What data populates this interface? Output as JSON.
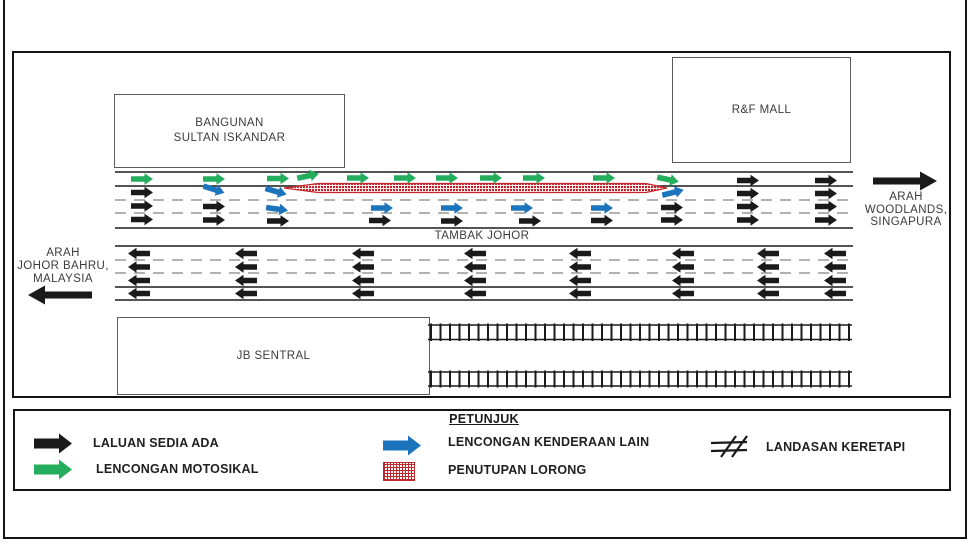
{
  "colors": {
    "existing_route": "#1A1A1A",
    "motorcycle_diversion": "#25AD5E",
    "other_vehicle_diversion": "#1C75BC",
    "lane_closure": "#C1272D",
    "label_text": "#3B3B3B"
  },
  "buildings": [
    {
      "name": "bangunan-sultan-iskandar",
      "lines": [
        "BANGUNAN",
        "SULTAN ISKANDAR"
      ]
    },
    {
      "name": "rf-mall",
      "lines": [
        "R&F MALL"
      ]
    },
    {
      "name": "jb-sentral",
      "lines": [
        "JB SENTRAL"
      ]
    }
  ],
  "labels": {
    "causeway": "TAMBAK JOHOR",
    "left_direction": [
      "ARAH",
      "JOHOR BAHRU,",
      "MALAYSIA"
    ],
    "right_direction": [
      "ARAH",
      "WOODLANDS,",
      "SINGAPURA"
    ]
  },
  "legend": {
    "title": "PETUNJUK",
    "items": [
      {
        "icon": "black-arrow-icon",
        "label": "LALUAN SEDIA ADA"
      },
      {
        "icon": "green-arrow-icon",
        "label": "LENCONGAN MOTOSIKAL"
      },
      {
        "icon": "blue-arrow-icon",
        "label": "LENCONGAN KENDERAAN LAIN"
      },
      {
        "icon": "red-hatch-icon",
        "label": "PENUTUPAN LORONG"
      },
      {
        "icon": "railway-icon",
        "label": "LANDASAN KERETAPI"
      }
    ]
  },
  "diagram": {
    "top_road": {
      "x1": 115,
      "x2": 853,
      "solid_lines": [
        172,
        186,
        228
      ],
      "dashed_lines": [
        200,
        213
      ]
    },
    "bottom_road": {
      "x1": 115,
      "x2": 853,
      "solid_lines": [
        246,
        287,
        300
      ],
      "dashed_lines": [
        260,
        273
      ]
    },
    "railways": [
      {
        "x1": 428,
        "x2": 852,
        "y1": 325,
        "y2": 339.5
      },
      {
        "x1": 428,
        "x2": 852,
        "y1": 372,
        "y2": 386
      }
    ],
    "closure_polygon": "284,188 318,183.5 646,183.5 667,188 646,192.5 318,192.5",
    "arrows_small": [
      [
        142,
        179,
        0,
        "g"
      ],
      [
        214,
        179,
        0,
        "g"
      ],
      [
        278,
        178.5,
        0,
        "g"
      ],
      [
        308,
        176,
        -12,
        "g"
      ],
      [
        358,
        178,
        0,
        "g"
      ],
      [
        405,
        178,
        0,
        "g"
      ],
      [
        447,
        178,
        0,
        "g"
      ],
      [
        491,
        178,
        0,
        "g"
      ],
      [
        534,
        178,
        0,
        "g"
      ],
      [
        604,
        178,
        0,
        "g"
      ],
      [
        668,
        179.5,
        12,
        "g"
      ],
      [
        214,
        189.5,
        18,
        "b"
      ],
      [
        276,
        191.5,
        16,
        "b"
      ],
      [
        277,
        209,
        8,
        "b"
      ],
      [
        382,
        208,
        0,
        "b"
      ],
      [
        452,
        208,
        0,
        "b"
      ],
      [
        522,
        208,
        0,
        "b"
      ],
      [
        602,
        208,
        0,
        "b"
      ],
      [
        673,
        192.5,
        -14,
        "b"
      ],
      [
        142,
        192.5,
        0,
        "k"
      ],
      [
        142,
        206,
        0,
        "k"
      ],
      [
        142,
        219.5,
        0,
        "k"
      ],
      [
        214,
        206.5,
        0,
        "k"
      ],
      [
        214,
        220,
        0,
        "k"
      ],
      [
        278,
        221,
        0,
        "k"
      ],
      [
        380,
        220.5,
        0,
        "k"
      ],
      [
        452,
        221,
        0,
        "k"
      ],
      [
        530,
        221,
        0,
        "k"
      ],
      [
        602,
        220.5,
        0,
        "k"
      ],
      [
        672,
        207.5,
        0,
        "k"
      ],
      [
        672,
        220,
        0,
        "k"
      ],
      [
        748,
        180.5,
        0,
        "k"
      ],
      [
        748,
        193.5,
        0,
        "k"
      ],
      [
        748,
        206.5,
        0,
        "k"
      ],
      [
        748,
        220,
        0,
        "k"
      ],
      [
        826,
        180.5,
        0,
        "k"
      ],
      [
        826,
        193.5,
        0,
        "k"
      ],
      [
        826,
        206.5,
        0,
        "k"
      ],
      [
        826,
        220,
        0,
        "k"
      ]
    ],
    "left_arrow_columns": [
      139,
      246,
      363,
      475,
      580,
      683,
      768,
      835
    ],
    "left_arrow_rows": [
      253.5,
      267,
      280.5,
      293.5
    ],
    "big_arrows": [
      {
        "x": 60,
        "y": 295,
        "angle": 180
      },
      {
        "x": 905,
        "y": 181,
        "angle": 0
      }
    ]
  }
}
